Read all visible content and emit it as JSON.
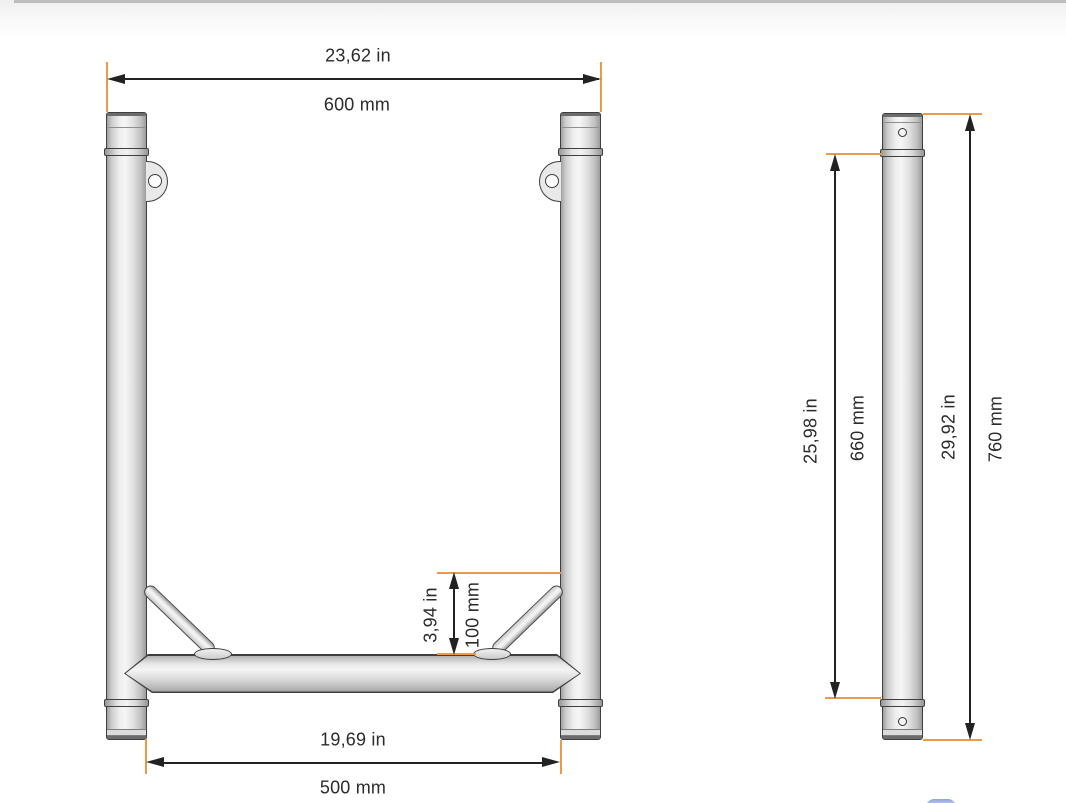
{
  "drawing": {
    "title": "truss-ladder-section-dimension-drawing",
    "front_view": {
      "overall_width": {
        "imperial": "23,62 in",
        "metric": "600 mm"
      },
      "inner_width": {
        "imperial": "19,69 in",
        "metric": "500 mm"
      },
      "brace_height": {
        "imperial": "3,94 in",
        "metric": "100 mm"
      }
    },
    "side_view": {
      "leg_height": {
        "imperial": "25,98 in",
        "metric": "660 mm"
      },
      "overall_height": {
        "imperial": "29,92 in",
        "metric": "760 mm"
      }
    },
    "colors": {
      "extension_line": "#EC9A48",
      "dimension_line": "#222222",
      "text": "#2B2B2B",
      "tube_outline": "#3F3F3F",
      "background": "#FFFFFF"
    }
  }
}
